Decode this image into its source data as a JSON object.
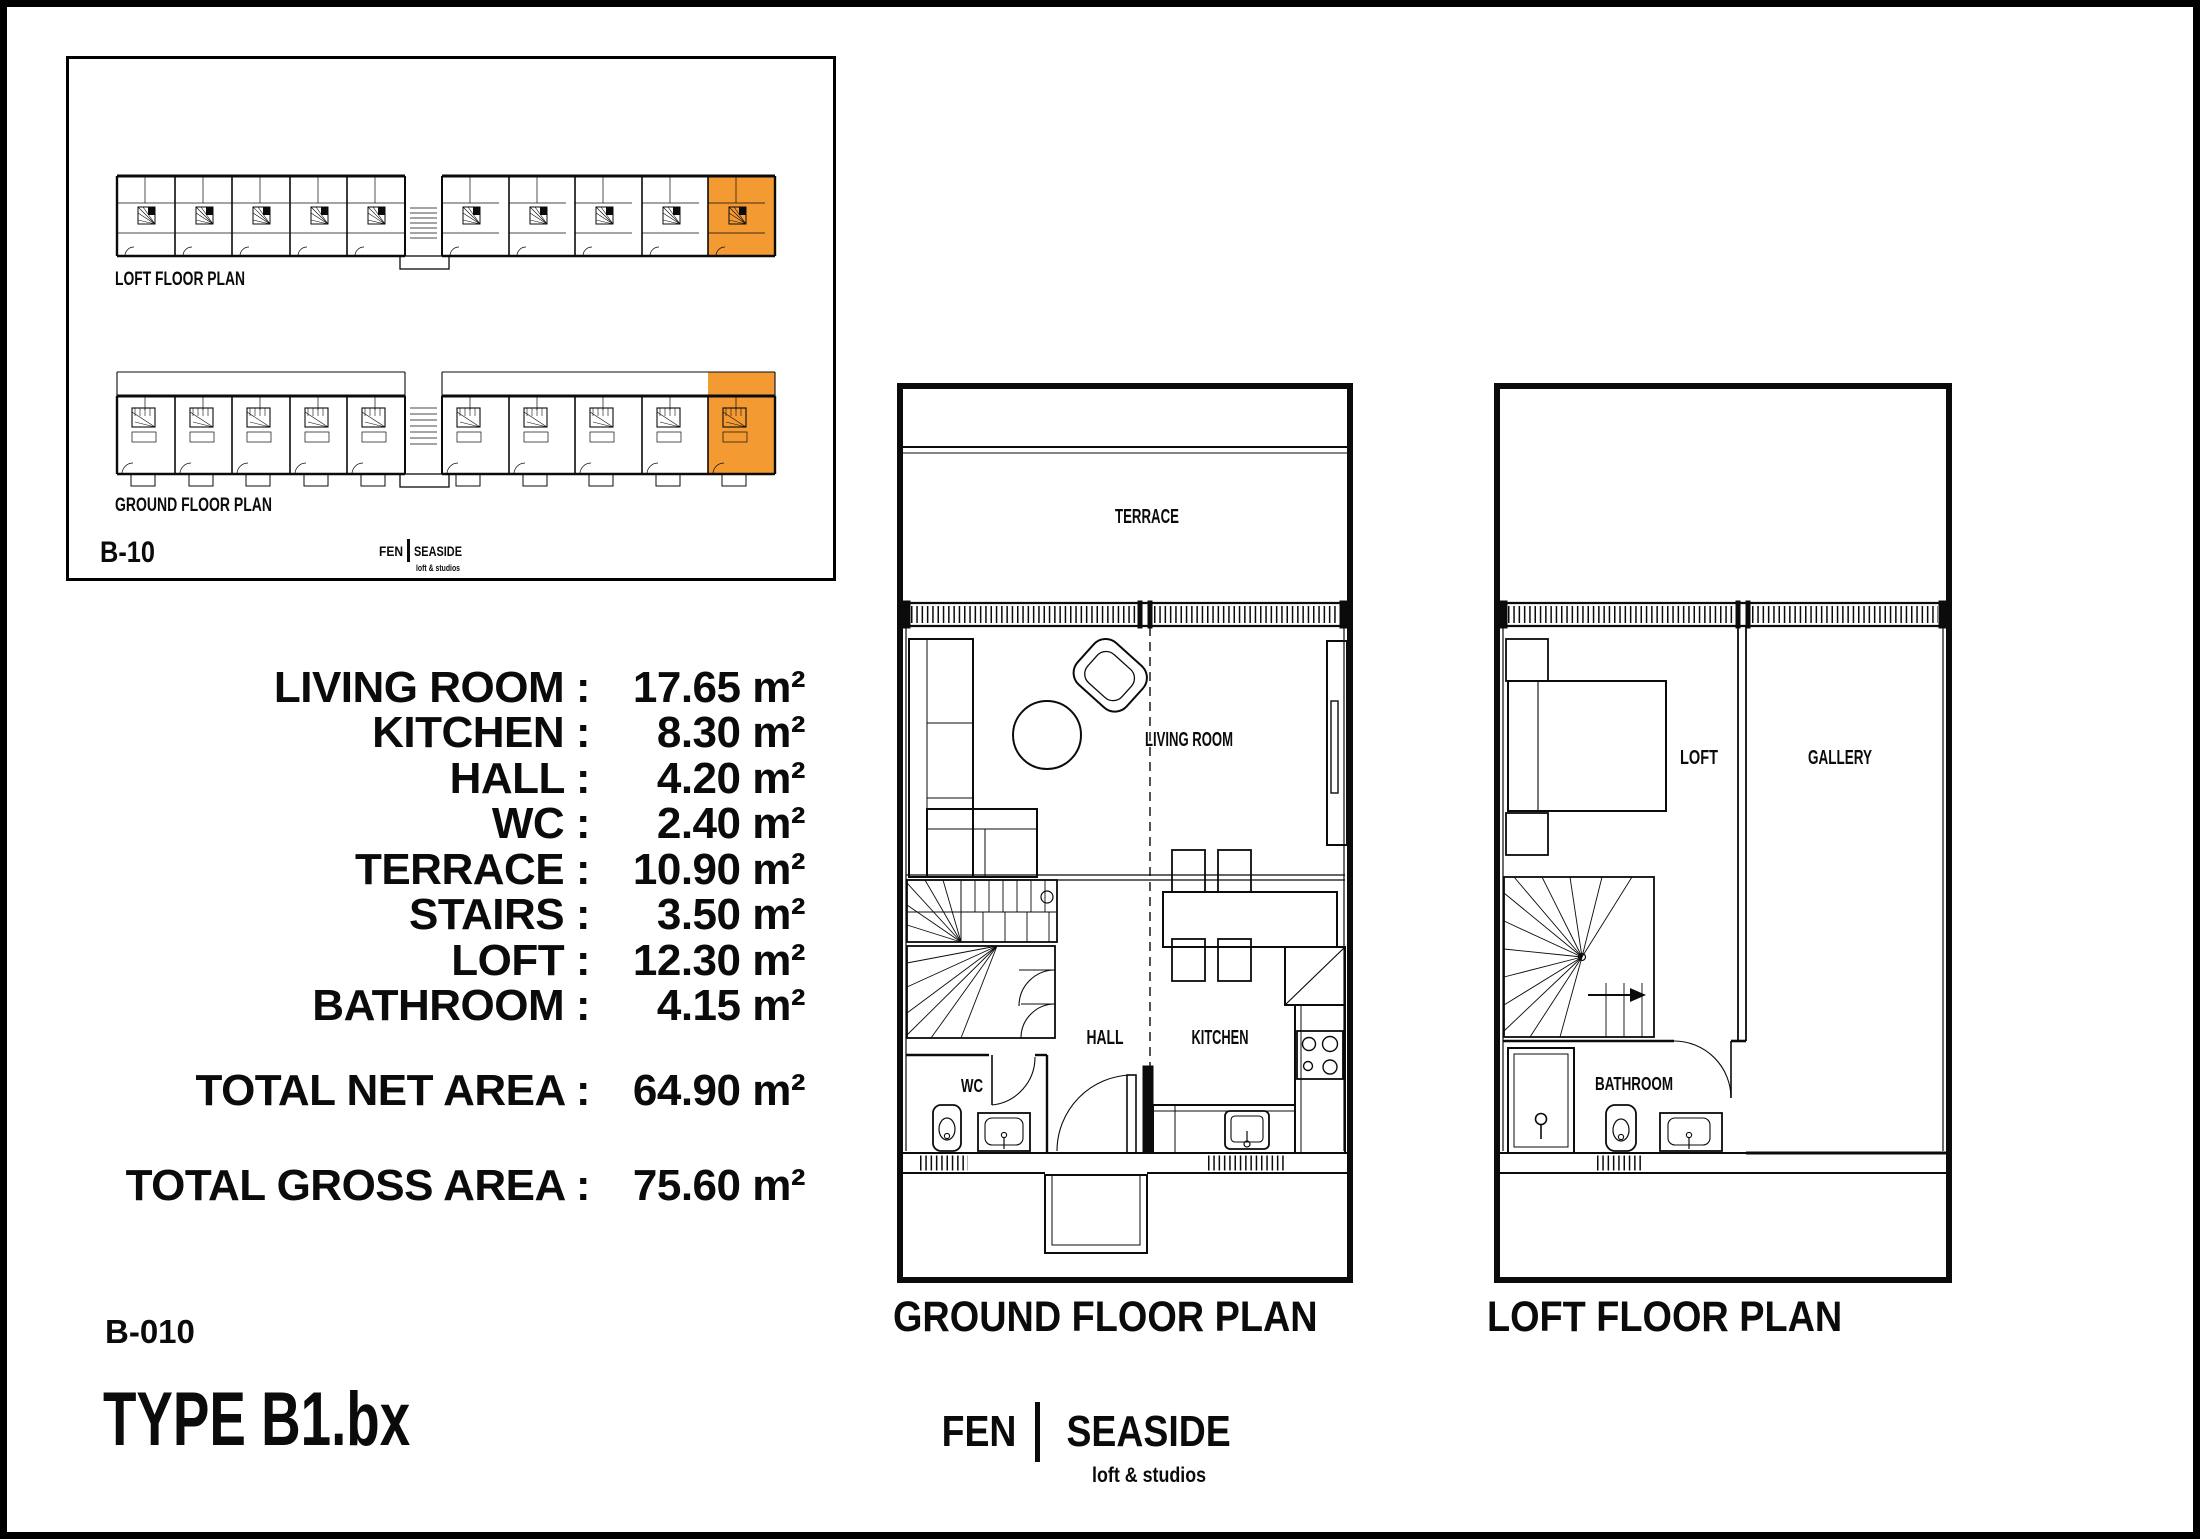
{
  "colors": {
    "highlight": "#F49A33",
    "ink": "#0b0b0b",
    "background": "#ffffff"
  },
  "key_plan": {
    "loft_strip_label": "LOFT FLOOR PLAN",
    "ground_strip_label": "GROUND FLOOR PLAN",
    "unit_code": "B-10",
    "brand": {
      "left": "FEN",
      "right": "SEASIDE",
      "tagline": "loft & studios"
    }
  },
  "area_table": {
    "rows": [
      {
        "label": "LIVING ROOM :",
        "value": "17.65 m²"
      },
      {
        "label": "KITCHEN :",
        "value": "8.30 m²"
      },
      {
        "label": "HALL :",
        "value": "4.20 m²"
      },
      {
        "label": "WC :",
        "value": "2.40 m²"
      },
      {
        "label": "TERRACE :",
        "value": "10.90 m²"
      },
      {
        "label": "STAIRS :",
        "value": "3.50 m²"
      },
      {
        "label": "LOFT :",
        "value": "12.30 m²"
      },
      {
        "label": "BATHROOM :",
        "value": "4.15 m²"
      }
    ],
    "total_net": {
      "label": "TOTAL NET AREA :",
      "value": "64.90 m²"
    },
    "total_gross": {
      "label": "TOTAL GROSS AREA :",
      "value": "75.60 m²"
    }
  },
  "ground_plan": {
    "title": "GROUND FLOOR PLAN",
    "labels": {
      "terrace": "TERRACE",
      "living_room": "LIVING ROOM",
      "hall": "HALL",
      "kitchen": "KITCHEN",
      "wc": "WC"
    }
  },
  "loft_plan": {
    "title": "LOFT FLOOR PLAN",
    "labels": {
      "loft": "LOFT",
      "gallery": "GALLERY",
      "bathroom": "BATHROOM"
    }
  },
  "title_block": {
    "sheet_code": "B-010",
    "type_label": "TYPE B1.bx"
  },
  "brand": {
    "left": "FEN",
    "right": "SEASIDE",
    "tagline": "loft & studios"
  }
}
